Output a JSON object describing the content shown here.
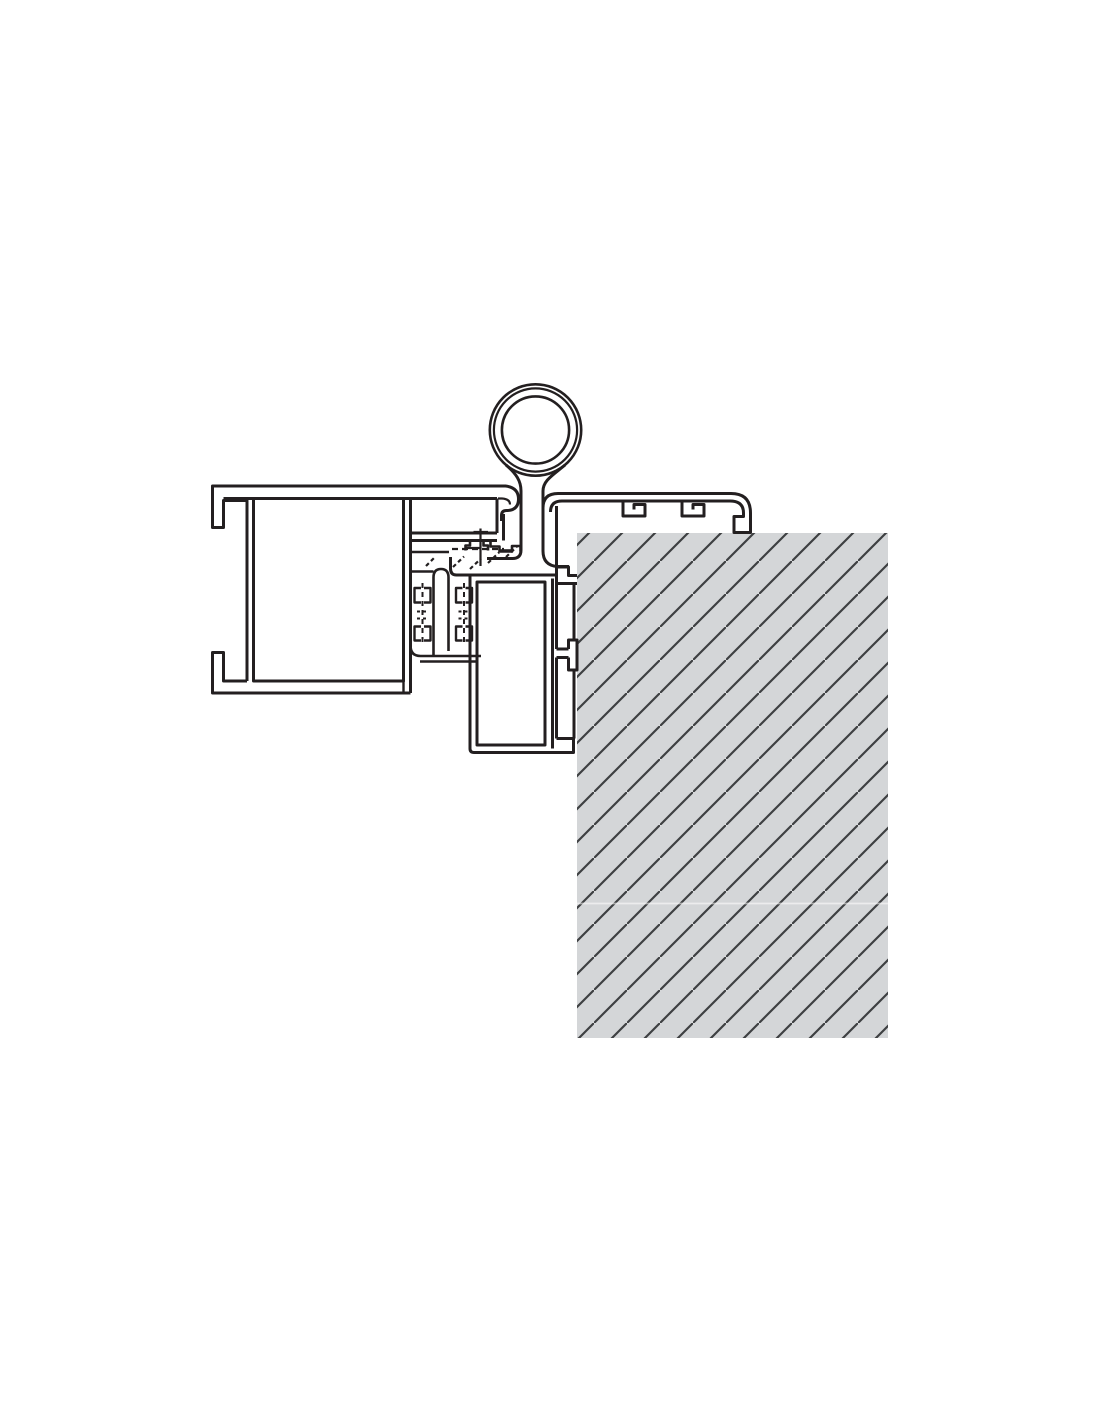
{
  "diagram": {
    "type": "technical-section-drawing",
    "description": "Cross-section detail drawing: aluminium door frame profile with brush seals, hinge knuckle with neck, wall cover trim with retaining hooks, door leaf profile anchored to a hatched wall"
  },
  "colors": {
    "background": "#ffffff",
    "line": "#231f20",
    "wall_fill": "#d4d6d8",
    "hatch_line": "#3e4042",
    "seam": "rgba(255,255,255,0.55)",
    "profile_fill": "#ffffff"
  },
  "wall": {
    "x": 577,
    "y": 533,
    "width": 311,
    "height": 505,
    "hatch_spacing": 33,
    "hatch_angle_deg": 45,
    "seam_y": 903
  },
  "hinge": {
    "center_x": 535.5,
    "center_y": 430,
    "outer_radius": 47,
    "mid_radius": 41.6,
    "inner_radius": 33.6
  }
}
